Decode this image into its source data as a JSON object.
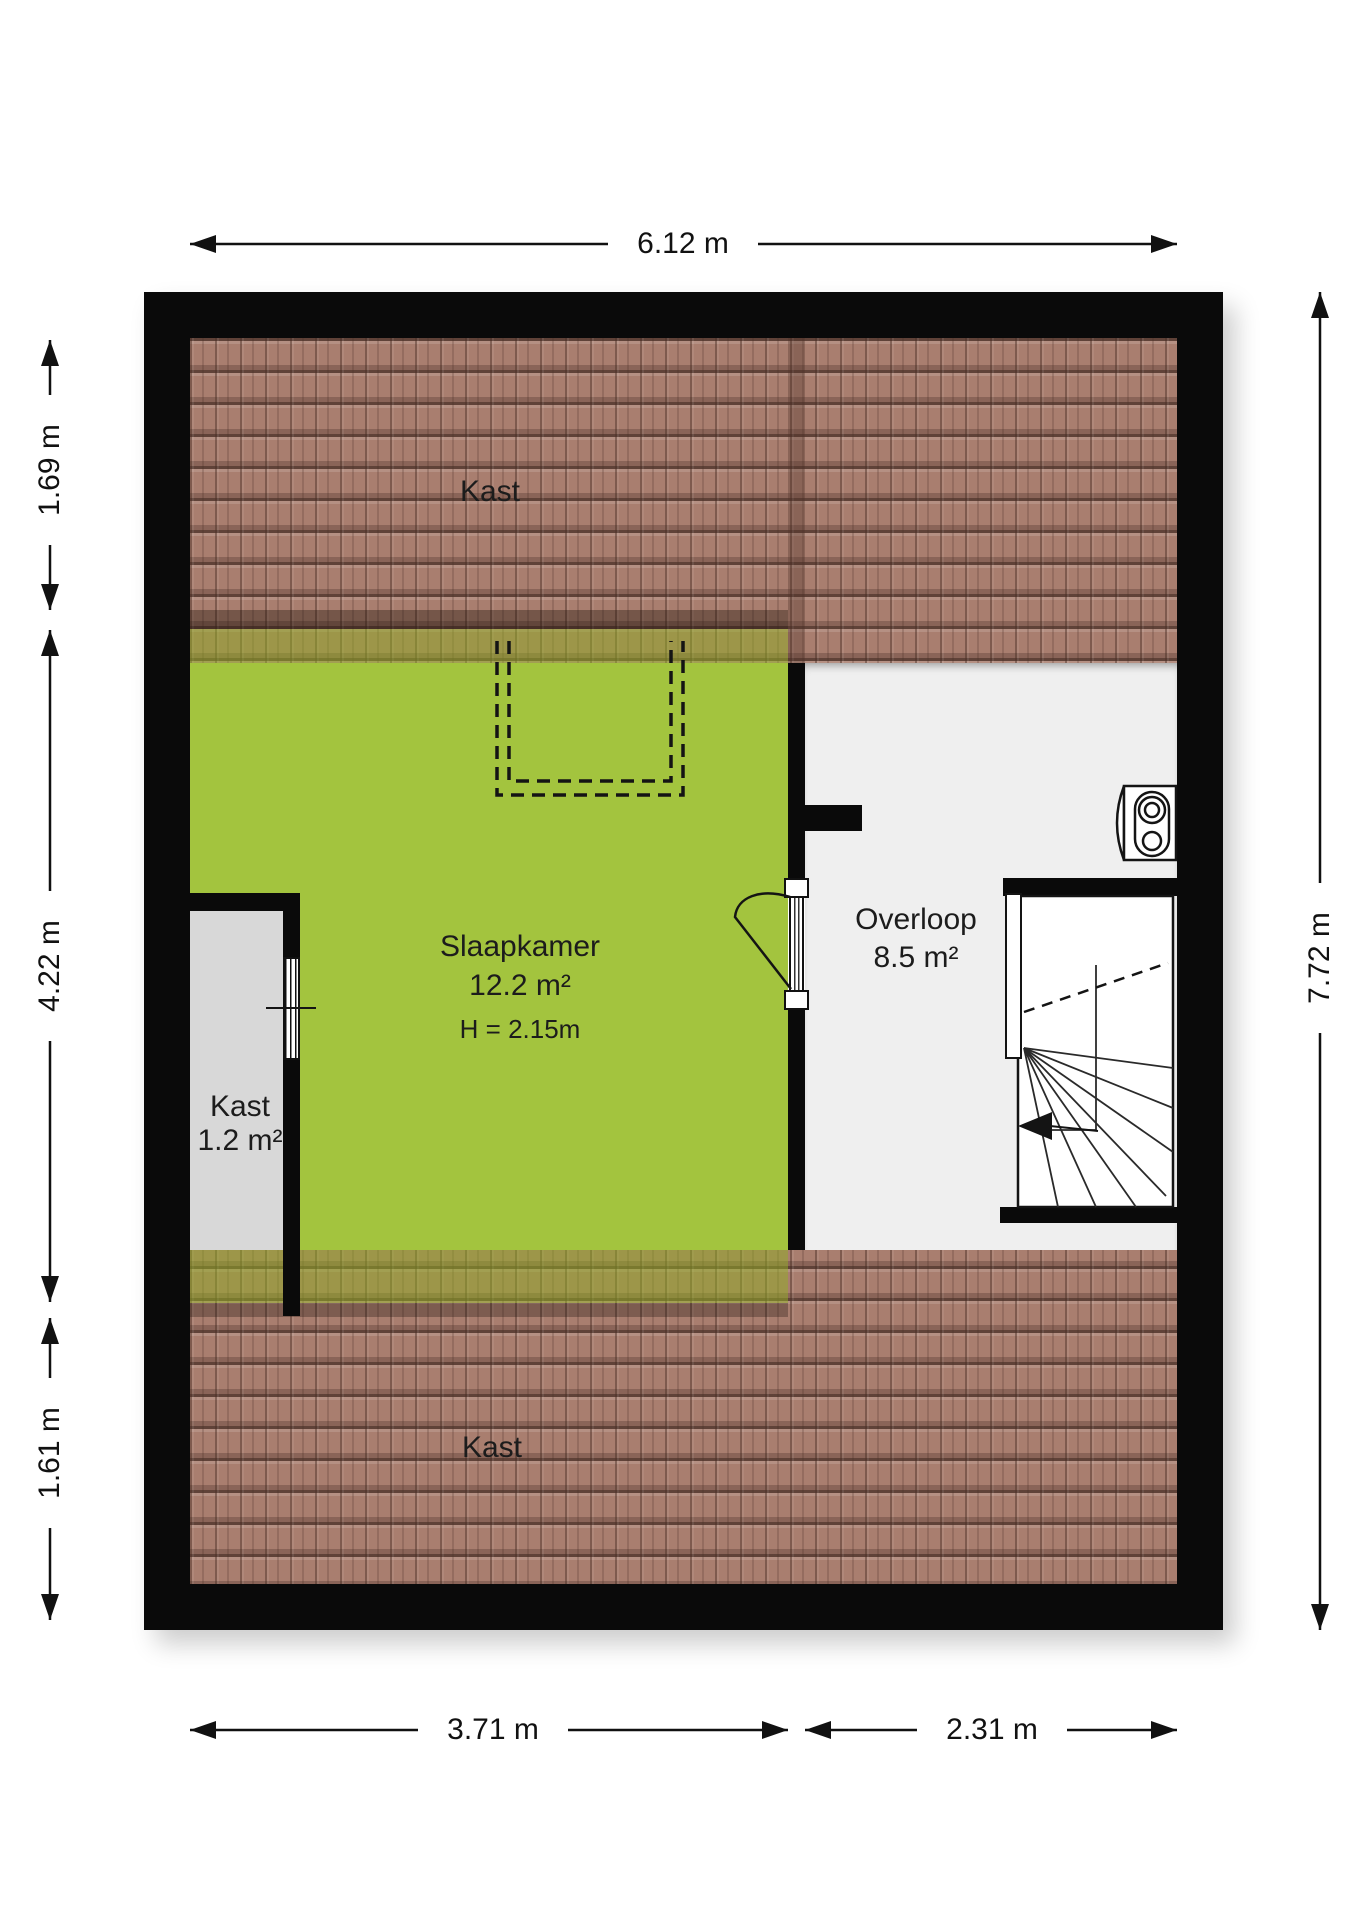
{
  "plan": {
    "rooms": {
      "kast_top": {
        "label": "Kast"
      },
      "slaapkamer": {
        "label": "Slaapkamer",
        "area": "12.2 m²",
        "ceiling_height": "H = 2.15m"
      },
      "kast_closet": {
        "label": "Kast",
        "area": "1.2 m²"
      },
      "overloop": {
        "label": "Overloop",
        "area": "8.5 m²"
      },
      "kast_bottom": {
        "label": "Kast"
      }
    },
    "dimensions": {
      "top_width": "6.12 m",
      "left_top": "1.69 m",
      "left_middle": "4.22 m",
      "left_bottom": "1.61 m",
      "right_height": "7.72 m",
      "bottom_left": "3.71 m",
      "bottom_right": "2.31 m"
    },
    "icons": {
      "boiler": "boiler-icon",
      "staircase": "staircase",
      "stairs_direction": "stairs-direction-arrow"
    },
    "colors": {
      "bedroom_green": "#a3c43e",
      "roof_tile_brown": "#a97e6f",
      "wall_black": "#0a0a0a",
      "closet_gray": "#d8d8d8",
      "landing_gray_white": "#efefef"
    }
  }
}
